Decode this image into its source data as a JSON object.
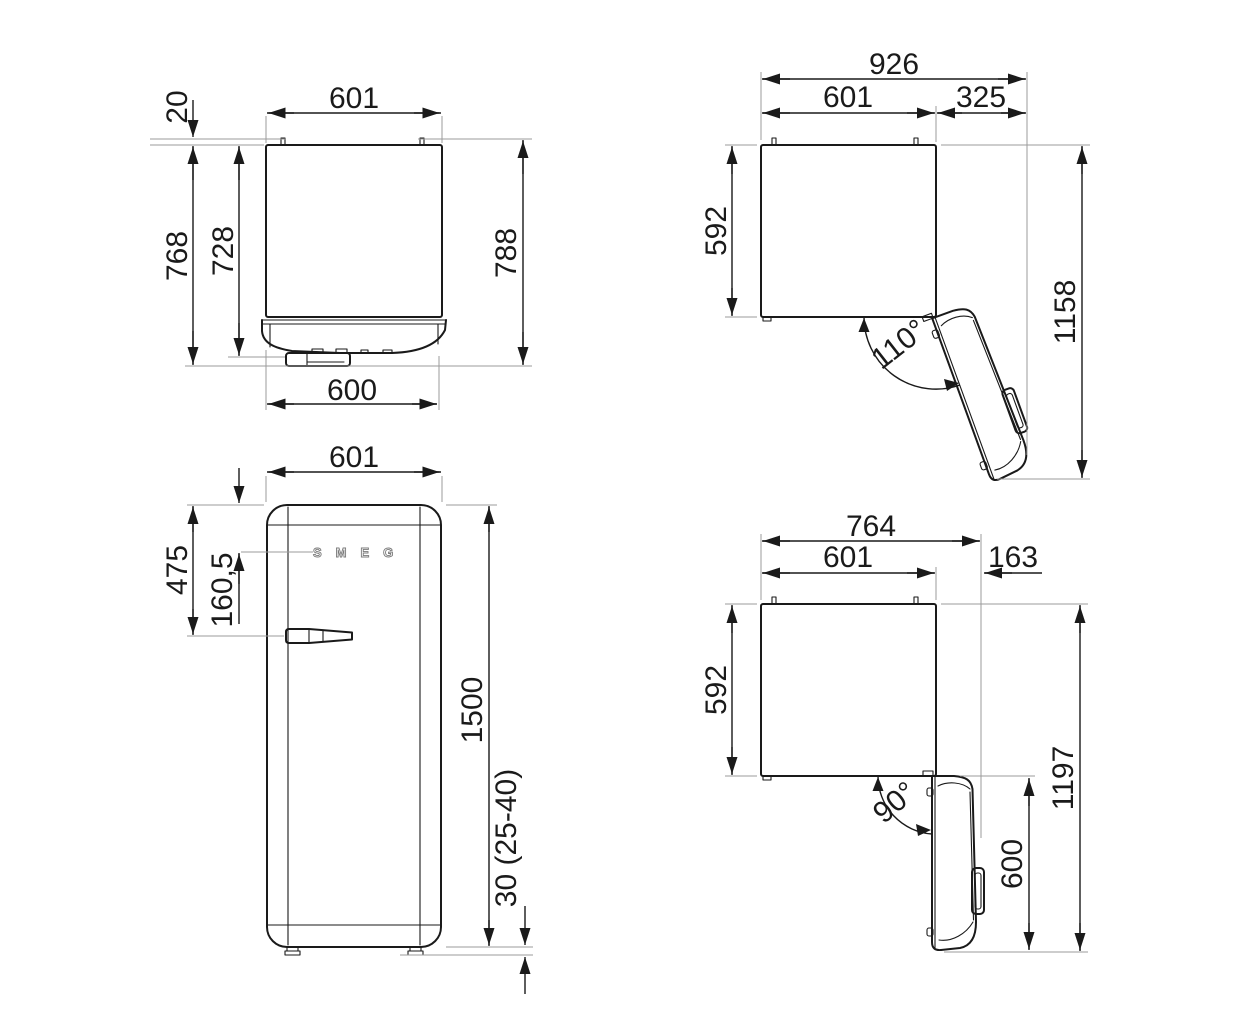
{
  "drawing": {
    "type": "technical-dimension-drawing",
    "product": "refrigerator",
    "logo": "SMEG",
    "colors": {
      "line": "#1a1a1a",
      "extension": "#9b9b9b",
      "background": "#ffffff"
    },
    "views": {
      "top_closed": {
        "name": "top-view-door-closed",
        "dims": {
          "width_top": "601",
          "wall_spacer": "20",
          "depth_body": "728",
          "depth_door": "768",
          "depth_total": "788",
          "width_bottom": "600"
        }
      },
      "top_open_110": {
        "name": "top-view-door-open-110",
        "dims": {
          "total_width": "926",
          "cabinet_width": "601",
          "door_clearance": "325",
          "cabinet_depth": "592",
          "total_depth": "1158",
          "door_angle": "110°"
        }
      },
      "front": {
        "name": "front-view",
        "dims": {
          "width": "601",
          "handle_from_top": "475",
          "logo_from_top": "160,5",
          "height": "1500",
          "feet_height": "30 (25-40)"
        }
      },
      "top_open_90": {
        "name": "top-view-door-open-90",
        "dims": {
          "total_width": "764",
          "cabinet_width": "601",
          "door_clearance": "163",
          "cabinet_depth": "592",
          "total_depth": "1197",
          "door_depth": "600",
          "door_angle": "90°"
        }
      }
    }
  }
}
